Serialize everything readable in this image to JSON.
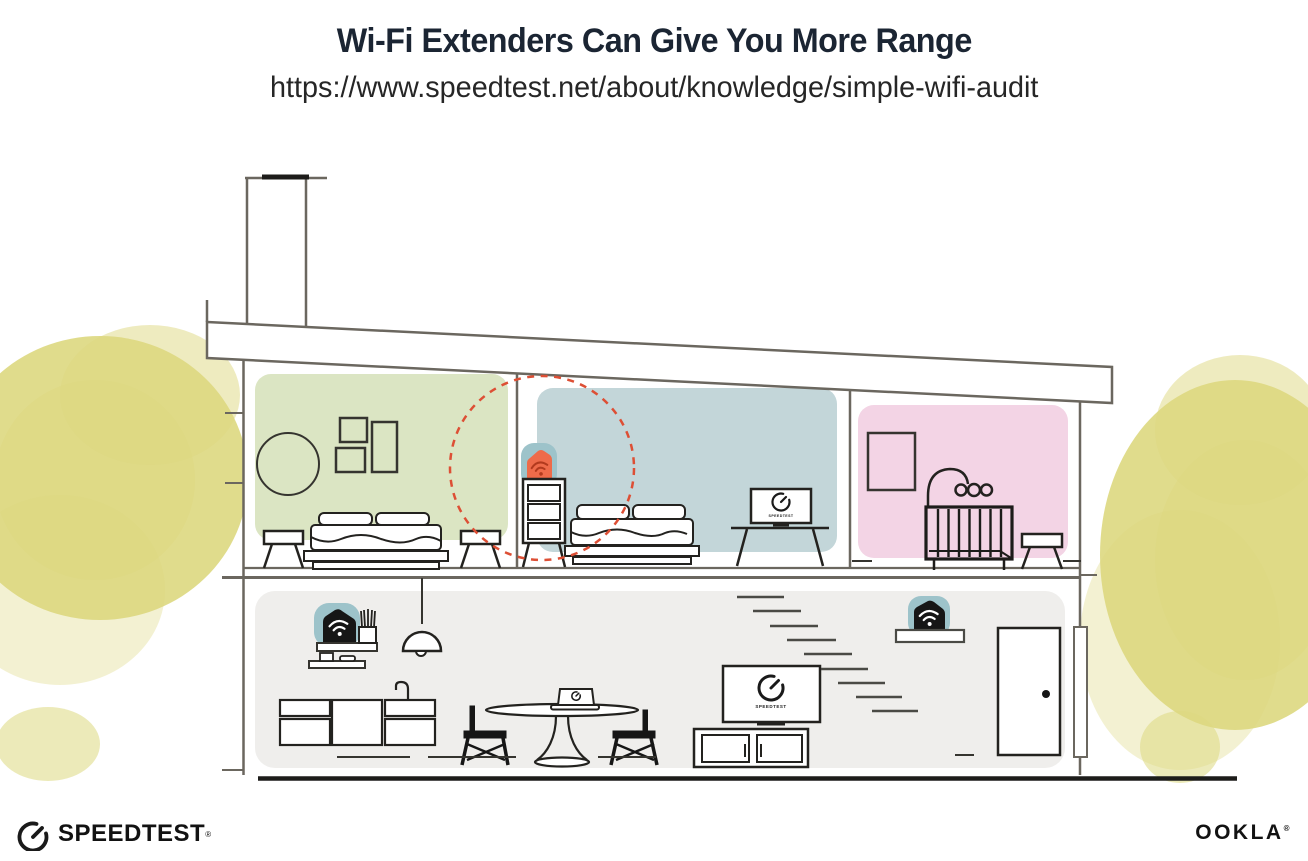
{
  "header": {
    "title": "Wi-Fi Extenders Can Give You More Range",
    "url": "https://www.speedtest.net/about/knowledge/simple-wifi-audit"
  },
  "screens": {
    "bedroom_tv_label": "SPEEDTEST",
    "living_room_tv_label": "SPEEDTEST"
  },
  "footer": {
    "speedtest_wordmark": "SPEEDTEST",
    "ookla_wordmark": "OOKLA",
    "registered_mark": "®"
  },
  "icons": {
    "wifi": "wifi-icon",
    "gauge": "speedtest-gauge-icon"
  },
  "colors": {
    "accent_orange": "#ee6b4a",
    "accent_orange_dark": "#b23a1e",
    "device_teal": "#9dc3ca",
    "device_black": "#161616",
    "range_dash_red": "#dd4f35",
    "room_green": "#dbe5c3",
    "room_blue": "#c3d6d9",
    "room_pink": "#f3d4e5",
    "floor_gray": "#efeeec",
    "foliage_yellow": "#ddd87f",
    "structure_line": "#6b675f",
    "furniture_line": "#23221f",
    "title_text": "#1b2533",
    "logo_black": "#121212"
  }
}
